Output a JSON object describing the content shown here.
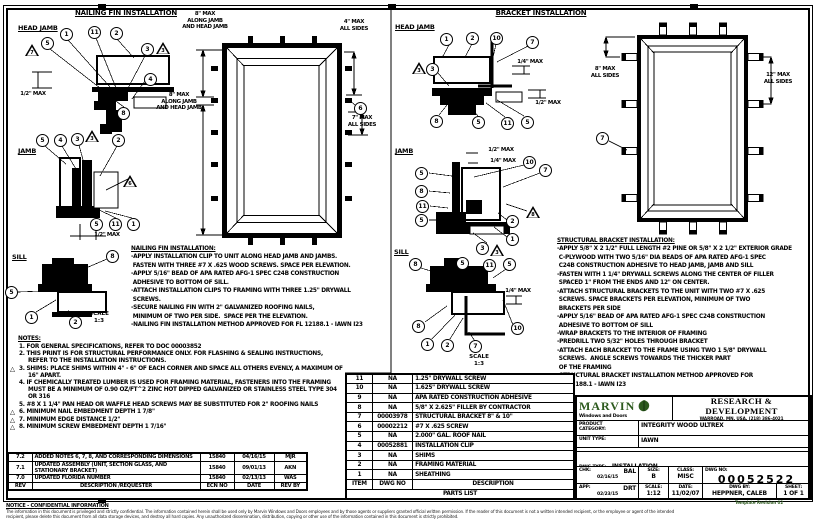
{
  "colors": {
    "ink": "#000000",
    "paper": "#ffffff",
    "brand_green": "#2d5a1e"
  },
  "icons": {
    "triangle": "△"
  },
  "titles": {
    "nailing_fin": "NAILING FIN INSTALLATION",
    "bracket": "BRACKET INSTALLATION"
  },
  "section_labels": {
    "nf_head": "HEAD JAMB",
    "nf_jamb": "JAMB",
    "nf_sill": "SILL",
    "br_head": "HEAD JAMB",
    "br_jamb": "JAMB",
    "br_sill": "SILL",
    "nf_scale": "SCALE\n1:3",
    "br_scale": "SCALE\n1:3"
  },
  "dims": {
    "nf_head_half": "1/2\" MAX",
    "elev_top": "8\" MAX\nALONG JAMB\nAND HEAD JAMB",
    "elev_left": "8\" MAX\nALONG JAMB\nAND HEAD JAMB",
    "elev_4": "4\" MAX\nALL SIDES",
    "elev_7": "7\" MAX\nALL SIDES",
    "nf_jamb_half": "1/2\" MAX",
    "br_head_quarter": "1/4\" MAX",
    "br_head_half": "1/2\" MAX",
    "br_jamb_half": "1/2\" MAX",
    "br_jamb_quarter": "1/4\" MAX",
    "br_sill_quarter": "1/4\" MAX",
    "brelev_8": "8\" MAX\nALL SIDES",
    "brelev_12": "12\" MAX\nALL SIDES"
  },
  "callouts": [
    {
      "n": "7",
      "x": 32,
      "y": 50,
      "s": "t"
    },
    {
      "n": "5",
      "x": 48,
      "y": 43,
      "s": "c"
    },
    {
      "n": "1",
      "x": 67,
      "y": 34,
      "s": "c"
    },
    {
      "n": "11",
      "x": 95,
      "y": 32,
      "s": "c"
    },
    {
      "n": "2",
      "x": 117,
      "y": 33,
      "s": "c"
    },
    {
      "n": "3",
      "x": 148,
      "y": 49,
      "s": "c"
    },
    {
      "n": "3",
      "x": 163,
      "y": 48,
      "s": "t"
    },
    {
      "n": "4",
      "x": 151,
      "y": 79,
      "s": "c"
    },
    {
      "n": "8",
      "x": 124,
      "y": 113,
      "s": "c"
    },
    {
      "n": "6",
      "x": 361,
      "y": 108,
      "s": "c"
    },
    {
      "n": "5",
      "x": 43,
      "y": 140,
      "s": "c"
    },
    {
      "n": "4",
      "x": 61,
      "y": 140,
      "s": "c"
    },
    {
      "n": "3",
      "x": 78,
      "y": 139,
      "s": "c"
    },
    {
      "n": "3",
      "x": 92,
      "y": 136,
      "s": "t"
    },
    {
      "n": "2",
      "x": 119,
      "y": 140,
      "s": "c"
    },
    {
      "n": "6",
      "x": 130,
      "y": 181,
      "s": "t"
    },
    {
      "n": "5",
      "x": 97,
      "y": 224,
      "s": "c"
    },
    {
      "n": "11",
      "x": 116,
      "y": 224,
      "s": "c"
    },
    {
      "n": "1",
      "x": 134,
      "y": 224,
      "s": "c"
    },
    {
      "n": "8",
      "x": 113,
      "y": 256,
      "s": "c"
    },
    {
      "n": "5",
      "x": 12,
      "y": 292,
      "s": "c"
    },
    {
      "n": "1",
      "x": 32,
      "y": 317,
      "s": "c"
    },
    {
      "n": "2",
      "x": 76,
      "y": 322,
      "s": "c"
    },
    {
      "n": "1",
      "x": 447,
      "y": 39,
      "s": "c"
    },
    {
      "n": "2",
      "x": 473,
      "y": 38,
      "s": "c"
    },
    {
      "n": "10",
      "x": 497,
      "y": 38,
      "s": "c"
    },
    {
      "n": "7",
      "x": 533,
      "y": 42,
      "s": "c"
    },
    {
      "n": "3",
      "x": 419,
      "y": 68,
      "s": "t"
    },
    {
      "n": "3",
      "x": 433,
      "y": 69,
      "s": "c"
    },
    {
      "n": "8",
      "x": 437,
      "y": 121,
      "s": "c"
    },
    {
      "n": "5",
      "x": 479,
      "y": 122,
      "s": "c"
    },
    {
      "n": "11",
      "x": 508,
      "y": 123,
      "s": "c"
    },
    {
      "n": "5",
      "x": 528,
      "y": 122,
      "s": "c"
    },
    {
      "n": "7",
      "x": 603,
      "y": 138,
      "s": "c"
    },
    {
      "n": "5",
      "x": 422,
      "y": 173,
      "s": "c"
    },
    {
      "n": "8",
      "x": 422,
      "y": 191,
      "s": "c"
    },
    {
      "n": "11",
      "x": 423,
      "y": 206,
      "s": "c"
    },
    {
      "n": "5",
      "x": 422,
      "y": 220,
      "s": "c"
    },
    {
      "n": "10",
      "x": 530,
      "y": 162,
      "s": "c"
    },
    {
      "n": "7",
      "x": 546,
      "y": 170,
      "s": "c"
    },
    {
      "n": "8",
      "x": 533,
      "y": 212,
      "s": "t"
    },
    {
      "n": "2",
      "x": 513,
      "y": 221,
      "s": "c"
    },
    {
      "n": "1",
      "x": 513,
      "y": 239,
      "s": "c"
    },
    {
      "n": "3",
      "x": 483,
      "y": 248,
      "s": "c"
    },
    {
      "n": "3",
      "x": 497,
      "y": 250,
      "s": "t"
    },
    {
      "n": "8",
      "x": 416,
      "y": 264,
      "s": "c"
    },
    {
      "n": "5",
      "x": 463,
      "y": 263,
      "s": "c"
    },
    {
      "n": "11",
      "x": 490,
      "y": 265,
      "s": "c"
    },
    {
      "n": "5",
      "x": 510,
      "y": 264,
      "s": "c"
    },
    {
      "n": "8",
      "x": 419,
      "y": 326,
      "s": "c"
    },
    {
      "n": "1",
      "x": 428,
      "y": 344,
      "s": "c"
    },
    {
      "n": "2",
      "x": 448,
      "y": 345,
      "s": "c"
    },
    {
      "n": "7",
      "x": 476,
      "y": 346,
      "s": "c"
    },
    {
      "n": "10",
      "x": 518,
      "y": 328,
      "s": "c"
    }
  ],
  "nailing_text": {
    "heading": "NAILING FIN INSTALLATION:",
    "body": "-APPLY INSTALLATION CLIP TO UNIT ALONG HEAD JAMB AND JAMBS.\n FASTEN WITH THREE #7 X .625 WOOD SCREWS. SPACE PER ELEVATION.\n-APPLY 5/16\" BEAD OF APA RATED AFG-1 SPEC C24B CONSTRUCTION\n ADHESIVE TO BOTTOM OF SILL.\n-ATTACH INSTALLATION CLIPS TO FRAMING WITH THREE 1.25\" DRYWALL\n SCREWS.\n-SECURE NAILING FIN WITH 2\" GALVANIZED ROOFING NAILS,\n MINIMUM OF TWO PER SIDE.  SPACE PER THE ELEVATION.\n-NAILING FIN INSTALLATION METHOD APPROVED FOR FL 12188.1 - IAWN I23"
  },
  "bracket_text": {
    "heading": "STRUCTURAL BRACKET INSTALLATION:",
    "body": "-APPLY 5/8\" X 2 1/2\" FULL LENGTH #2 PINE OR 5/8\" X 2 1/2\" EXTERIOR GRADE\n C-PLYWOOD WITH TWO 5/16\" DIA BEADS OF APA RATED AFG-1 SPEC\n C24B CONSTRUCTION ADHESIVE TO HEAD JAMB, JAMB AND SILL\n-FASTEN WITH 1 1/4\" DRYWALL SCREWS ALONG THE CENTER OF FILLER\n SPACED 1\" FROM THE ENDS AND 12\" ON CENTER.\n-ATTACH STRUCTURAL BRACKETS TO THE UNIT WITH TWO #7 X .625\n SCREWS. SPACE BRACKETS PER ELEVATION, MINIMUM OF TWO\n BRACKETS PER SIDE\n-APPLY 5/16\" BEAD OF APA RATED AFG-1 SPEC C24B CONSTRUCTION\n ADHESIVE TO BOTTOM OF SILL\n-WRAP BRACKETS TO THE INTERIOR OF FRAMING\n-PREDRILL TWO 5/32\" HOLES THROUGH BRACKET\n-ATTACH EACH BRACKET TO THE FRAME USING TWO 1 5/8\" DRYWALL\n SCREWS.  ANGLE SCREWS TOWARDS THE THICKER PART\n OF THE FRAMING\n-STRUCTURAL BRACKET INSTALLATION METHOD APPROVED FOR\n FL 12188.1 - IAWN I23"
  },
  "notes": {
    "heading": "NOTES:",
    "items": [
      {
        "tri": false,
        "text": "1. FOR GENERAL SPECIFICATIONS, REFER TO DOC 00003852"
      },
      {
        "tri": false,
        "text": "2. THIS PRINT IS FOR STRUCTURAL PERFORMANCE ONLY. FOR FLASHING & SEALING INSTRUCTIONS, REFER TO THE INSTALLATION INSTRUCTIONS."
      },
      {
        "tri": true,
        "text": "3. SHIMS: PLACE SHIMS WITHIN 4\" - 6\" OF EACH CORNER AND SPACE ALL OTHERS EVENLY, A MAXIMUM OF 16\" APART."
      },
      {
        "tri": false,
        "text": "4. IF CHEMICALLY TREATED LUMBER IS USED FOR FRAMING MATERIAL, FASTENERS INTO THE FRAMING MUST BE A MINIMUM OF 0.90 OZ/FT^2 ZINC HOT DIPPED GALVANIZED OR STAINLESS STEEL TYPE 304 OR 316"
      },
      {
        "tri": false,
        "text": "5. #8 X 1 1/4\" PAN HEAD OR WAFFLE HEAD SCREWS MAY BE SUBSTITUTED FOR 2\" ROOFING NAILS"
      },
      {
        "tri": true,
        "text": "6. MINIMUM NAIL EMBEDMENT DEPTH 1 7/8\""
      },
      {
        "tri": true,
        "text": "7. MINIMUM EDGE DISTANCE 1/2\""
      },
      {
        "tri": true,
        "text": "8. MINIMUM SCREW EMBEDMENT DEPTH 1 7/16\""
      }
    ]
  },
  "parts_list": {
    "caption": "PARTS LIST",
    "headers": [
      "ITEM",
      "DWG NO",
      "DESCRIPTION"
    ],
    "rows": [
      {
        "item": "11",
        "dwg": "NA",
        "desc": "1.25\" DRYWALL SCREW",
        "heavy": false
      },
      {
        "item": "10",
        "dwg": "NA",
        "desc": "1.625\" DRYWALL SCREW",
        "heavy": false
      },
      {
        "item": "9",
        "dwg": "NA",
        "desc": "APA RATED CONSTRUCTION ADHESIVE",
        "heavy": false
      },
      {
        "item": "8",
        "dwg": "NA",
        "desc": "5/8\" X 2.625\" FILLER BY CONTRACTOR",
        "heavy": false
      },
      {
        "item": "7",
        "dwg": "00003978",
        "desc": "STRUCTURAL BRACKET 8\" & 10\"",
        "heavy": true
      },
      {
        "item": "6",
        "dwg": "00002212",
        "desc": "#7 X .625 SCREW",
        "heavy": true
      },
      {
        "item": "5",
        "dwg": "NA",
        "desc": "2.000\" GAL. ROOF NAIL",
        "heavy": false
      },
      {
        "item": "4",
        "dwg": "00052881",
        "desc": "INSTALLATION CLIP",
        "heavy": false
      },
      {
        "item": "3",
        "dwg": "NA",
        "desc": "SHIMS",
        "heavy": false
      },
      {
        "item": "2",
        "dwg": "NA",
        "desc": "FRAMING MATERIAL",
        "heavy": false
      },
      {
        "item": "1",
        "dwg": "NA",
        "desc": "SHEATHING",
        "heavy": false
      }
    ]
  },
  "revisions": {
    "headers": [
      "REV",
      "DESCRIPTION /REQUESTER",
      "ECN NO",
      "DATE",
      "REV BY"
    ],
    "rows": [
      [
        "7.2",
        "ADDED NOTES 6, 7, 8, AND CORRESPONDING DIMENSIONS",
        "15840",
        "04/16/15",
        "MJR"
      ],
      [
        "7.1",
        "UPDATED ASSEMBLY (UNIT, SECTION GLASS, AND STATIONARY BRACKET)",
        "15840",
        "09/01/13",
        "AKN"
      ],
      [
        "7.0",
        "UPDATED FLORIDA NUMBER",
        "15840",
        "02/13/13",
        "WAS"
      ]
    ]
  },
  "title_block": {
    "company": "MARVIN",
    "tagline": "Windows and Doors",
    "dept": "RESEARCH & DEVELOPMENT",
    "address": "WARROAD, MN, USA, (218) 386-4021",
    "product_category_label": "PRODUCT\nCATEGORY:",
    "product_category": "INTEGRITY WOOD ULTREX",
    "unit_type_label": "UNIT TYPE:",
    "unit_type": "IAWN",
    "dwg_type_label": "DWG TYPE:",
    "dwg_type": "INSTALLATION",
    "description_label": "DESCRIPTION:",
    "description": "FL12188, IMPACT, AWNING",
    "chk_label": "CHK:",
    "chk": "BAL",
    "chk_date": "02/16/15",
    "size_label": "SIZE:",
    "size": "B",
    "class_label": "CLASS:",
    "class": "MISC",
    "dwg_no_label": "DWG NO:",
    "dwg_no": "00052522",
    "app_label": "APP:",
    "app": "DRT",
    "app_date": "02/23/15",
    "scale_label": "SCALE:",
    "scale": "1:12",
    "date_label": "DATE:",
    "date": "11/02/07",
    "dwg_by_label": "DWG BY:",
    "dwg_by": "HEPPNER, CALEB",
    "sheet_label": "SHEET:",
    "sheet": "1 OF 1",
    "template_note": "Template Revision 02"
  },
  "footer": {
    "heading": "NOTICE - CONFIDENTIAL INFORMATION",
    "line1": "The information in this document is privileged and strictly confidential.  The information contained herein shall be used only by Marvin Windows and Doors employees and by those agents or suppliers granted official written permission.  If the reader of this document is not a written intended recipient, or the employee or agent of the intended",
    "line2": "recipient, please delete this document from all data storage devices, and destroy all hard copies.  Any unauthorized dissemination, distribution, copying or other use of the information contained in this document is strictly prohibited."
  }
}
